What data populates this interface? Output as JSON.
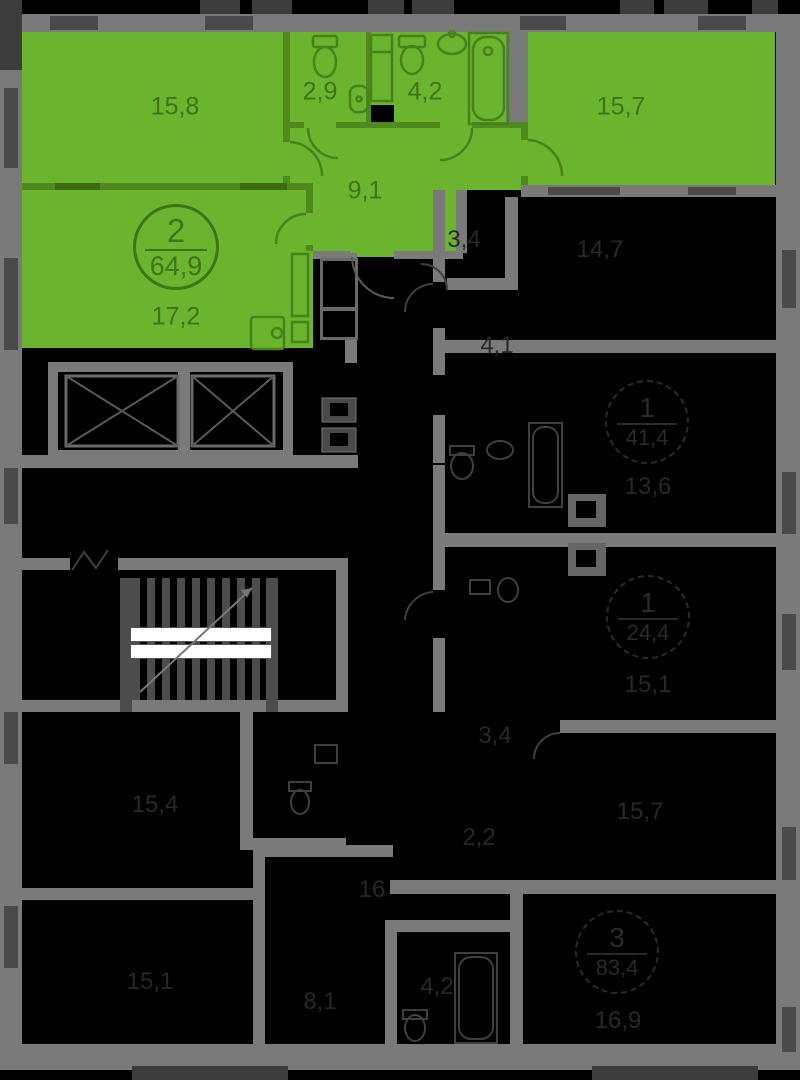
{
  "apartment": {
    "badge": {
      "rooms": "2",
      "area": "64,9"
    },
    "areas": {
      "living": "15,8",
      "wc": "2,9",
      "bath": "4,2",
      "bedroom": "15,7",
      "hall": "9,1",
      "kitchen_living": "17,2"
    }
  },
  "neighbors": {
    "closet_top": "3,4",
    "bedroom_top_right": "14,7",
    "hall_right": "4,1",
    "badge_right_upper": {
      "rooms": "1",
      "area": "41,4"
    },
    "room_right_upper": "13,6",
    "badge_right_mid": {
      "rooms": "1",
      "area": "24,4"
    },
    "room_right_mid": "15,1",
    "room_right_lower": "15,7",
    "badge_bottom_right": {
      "rooms": "3",
      "area": "83,4"
    },
    "room_bottom_right": "16,9",
    "room_left_mid": "15,4",
    "room_left_bottom": "15,1",
    "hall_bottom": "16",
    "room_bottom": "8,1",
    "bath_bottom": "4,2",
    "closet_mid": "3,4",
    "closet_mid2": "2,2"
  },
  "colors": {
    "background": "#000000",
    "apartment_fill": "#6ab42e",
    "apartment_text": "#3e7517",
    "walls": "#7a7a7a",
    "walls_dark": "#3c3c3c",
    "dim_text": "#282828",
    "stair_strip": "#ffffff"
  }
}
